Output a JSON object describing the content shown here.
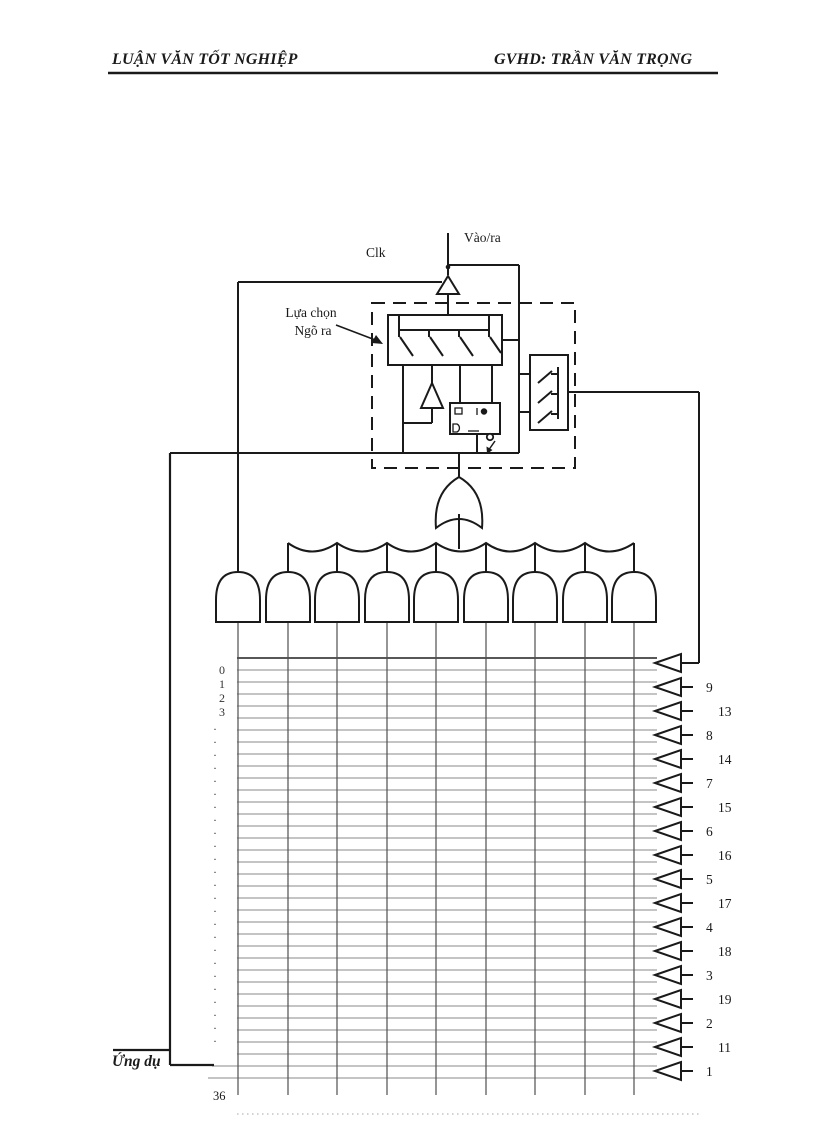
{
  "header": {
    "left": "LUẬN VĂN TỐT NGHIỆP",
    "right": "GVHD: TRẦN VĂN TRỌNG"
  },
  "diagram": {
    "clk_label": "Clk",
    "io_label": "Vào/ra",
    "select_line1": "Lựa chọn",
    "select_line2": "Ngõ ra",
    "and_gate_count": 9,
    "matrix": {
      "row_count": 36,
      "row_labels": [
        "0",
        "1",
        "2",
        "3"
      ],
      "dot_glyph": ".",
      "dot_count": 25
    },
    "led_pins": [
      "",
      "9",
      "13",
      "8",
      "14",
      "7",
      "15",
      "6",
      "16",
      "5",
      "17",
      "4",
      "18",
      "3",
      "19",
      "2",
      "11",
      "1"
    ]
  },
  "footer": {
    "left_text": "Ứng dụ",
    "page_number": "36"
  },
  "colors": {
    "line": "#1a1a1a",
    "grid": "#8a8a8a",
    "grid_dark": "#3f3f3f",
    "column": "#4f4f4f",
    "dotted": "#b8b8b8"
  }
}
